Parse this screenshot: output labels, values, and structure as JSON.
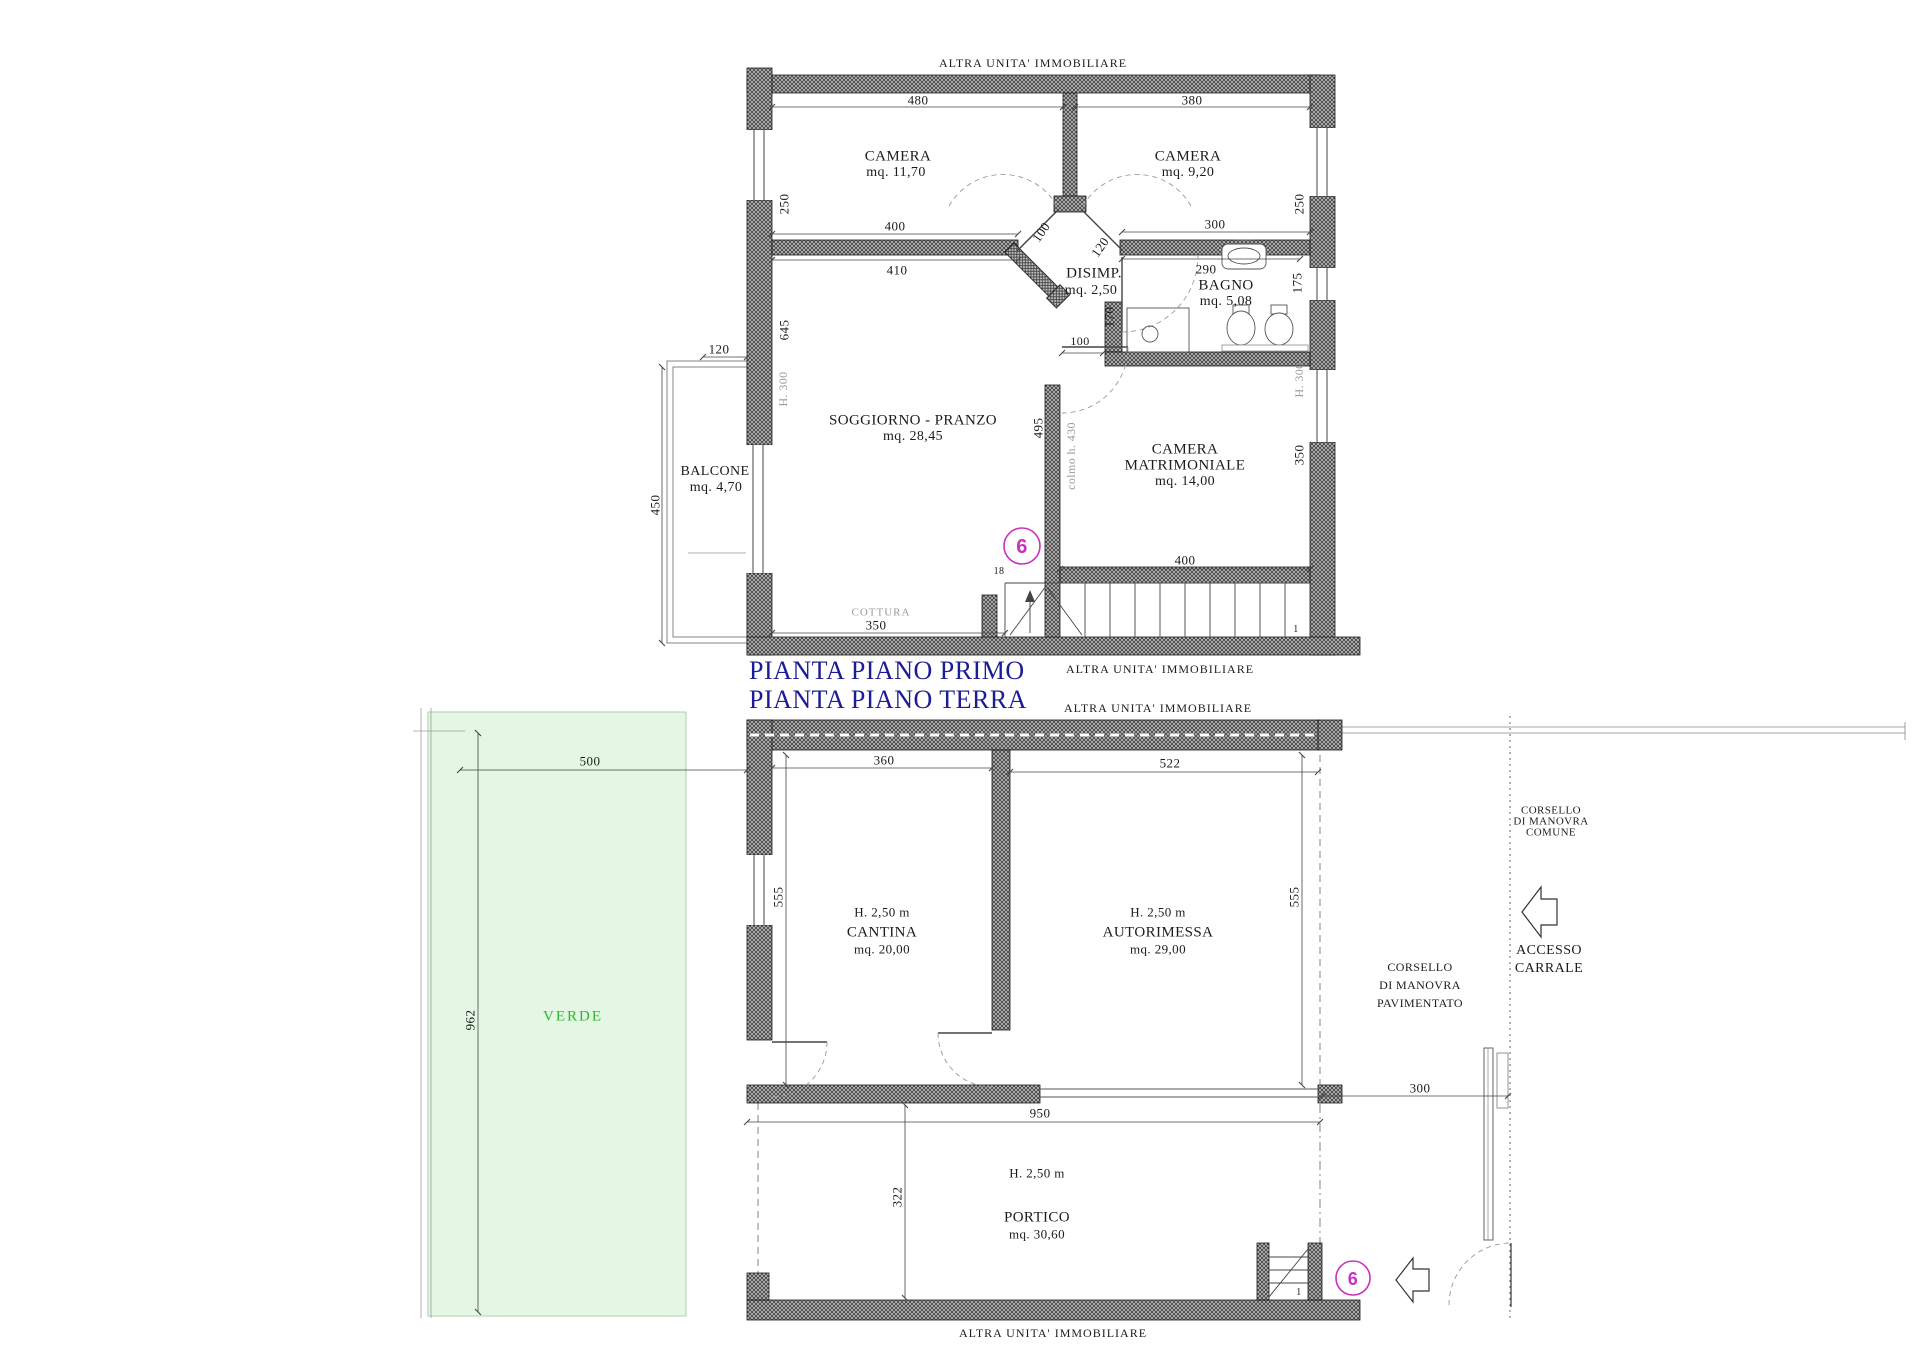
{
  "common": {
    "other_unit_label": "ALTRA UNITA' IMMOBILIARE",
    "unit_number": "6"
  },
  "titles": {
    "first_floor": "PIANTA PIANO PRIMO",
    "ground_floor": "PIANTA PIANO TERRA"
  },
  "colors": {
    "title_blue": "#1c1c96",
    "unit_magenta": "#cb2fc0",
    "verde_green": "#2db52d",
    "note_gray": "#999999"
  },
  "plan1": {
    "rooms": {
      "camera1": {
        "name": "CAMERA",
        "area": "mq. 11,70"
      },
      "camera2": {
        "name": "CAMERA",
        "area": "mq. 9,20"
      },
      "disimpegno": {
        "name": "DISIMP.",
        "area": "mq. 2,50"
      },
      "bagno": {
        "name": "BAGNO",
        "area": "mq. 5,08"
      },
      "soggiorno": {
        "name": "SOGGIORNO - PRANZO",
        "area": "mq. 28,45"
      },
      "camera_matrimoniale": {
        "name1": "CAMERA",
        "name2": "MATRIMONIALE",
        "area": "mq. 14,00"
      },
      "balcone": {
        "name": "BALCONE",
        "area": "mq. 4,70"
      },
      "cottura": "COTTURA"
    },
    "dims": {
      "top_camera1": "480",
      "top_camera2": "380",
      "left_250": "250",
      "left_645": "645",
      "left_h300": "H. 300",
      "balcone_120": "120",
      "balcone_450": "450",
      "wall_400": "400",
      "wall_410": "410",
      "door_100": "100",
      "door_120": "120",
      "bagno_300": "300",
      "bagno_290": "290",
      "bagno_170": "170",
      "right_250": "250",
      "right_175": "175",
      "right_h300": "H. 300",
      "right_350": "350",
      "sogg_495": "495",
      "colmo": "colmo h. 430",
      "matr_door_100": "100",
      "matr_400": "400",
      "sogg_350": "350",
      "stair_18": "18",
      "stair_1": "1"
    }
  },
  "plan2": {
    "rooms": {
      "verde": "VERDE",
      "cantina": {
        "height": "H. 2,50 m",
        "name": "CANTINA",
        "area": "mq. 20,00"
      },
      "autorimessa": {
        "height": "H. 2,50 m",
        "name": "AUTORIMESSA",
        "area": "mq. 29,00"
      },
      "portico": {
        "height": "H. 2,50 m",
        "name": "PORTICO",
        "area": "mq. 30,60"
      },
      "corsello_pavimentato": {
        "l1": "CORSELLO",
        "l2": "DI MANOVRA",
        "l3": "PAVIMENTATO"
      },
      "corsello_comune": {
        "l1": "CORSELLO",
        "l2": "DI MANOVRA",
        "l3": "COMUNE"
      },
      "accesso_carrale": {
        "l1": "ACCESSO",
        "l2": "CARRALE"
      }
    },
    "dims": {
      "verde_500": "500",
      "verde_962": "962",
      "cantina_360": "360",
      "auto_522": "522",
      "left_555": "555",
      "right_555": "555",
      "portico_950": "950",
      "portico_322": "322",
      "corsello_300": "300",
      "stair_1": "1"
    }
  }
}
